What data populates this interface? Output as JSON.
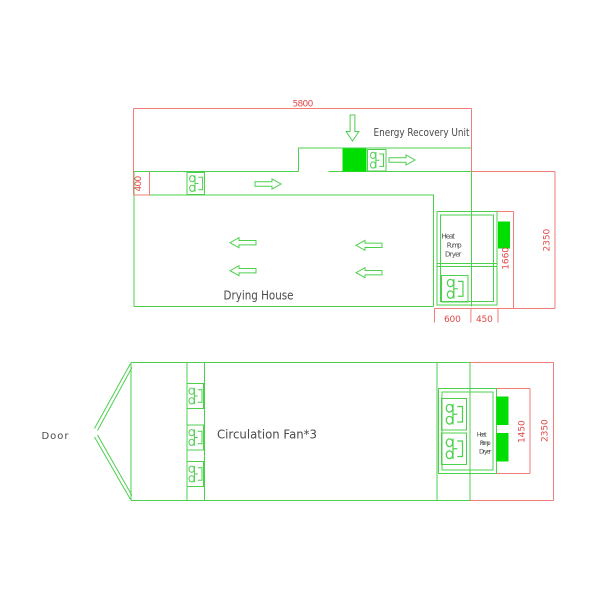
{
  "colors": {
    "line_green": "#4cd04c",
    "fill_green": "#00dd00",
    "dim_line_red": "#f07c7c",
    "dim_text_red": "#e04848",
    "label_gray": "#4a4a4a"
  },
  "top_view": {
    "label": "Drying House",
    "eru_label": "Energy Recovery Unit",
    "hpd": [
      "Heat",
      "Pump",
      "Dryer"
    ],
    "dim_5800": "5800",
    "dim_400": "400",
    "dim_2350": "2350",
    "dim_1660": "1660",
    "dim_600": "600",
    "dim_450": "450"
  },
  "bottom_view": {
    "door_label": "Door",
    "fan_label": "Circulation Fan*3",
    "hpd": [
      "Heat",
      "Pump",
      "Dryer"
    ],
    "dim_1450": "1450",
    "dim_2350": "2350"
  }
}
